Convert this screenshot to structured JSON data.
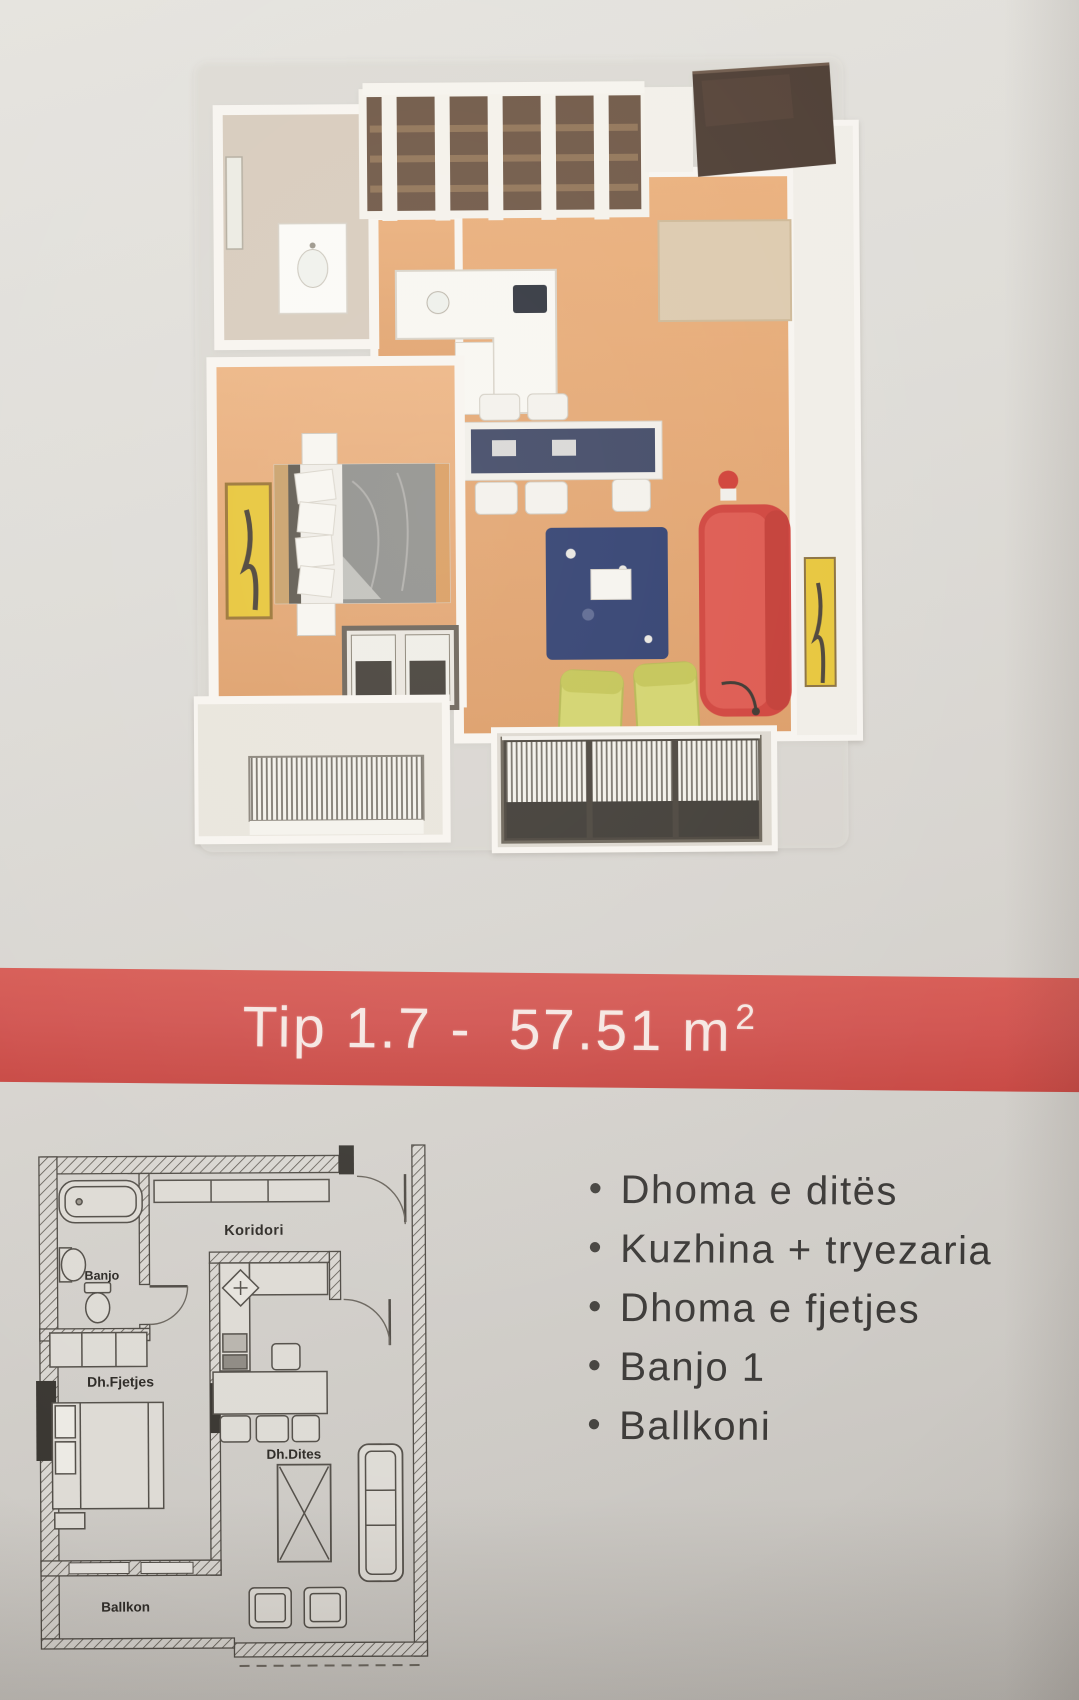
{
  "banner": {
    "title_main": "Tip 1.7 -  57.51 m",
    "title_exponent": "2",
    "background_color": "#d15450",
    "text_color": "#f6e7e2"
  },
  "floorplan_3d": {
    "colors": {
      "wood_floor": "#e3a672",
      "sofa": "#d8473f",
      "lounge_chairs": "#d2d36b",
      "area_rug": "#2e3d6e",
      "wall_art": "#e7c538",
      "bed_duvet": "#90908c",
      "bathroom_floor": "#d7cbbc",
      "dark_wardrobe": "#4b3b31"
    }
  },
  "floorplan_2d": {
    "labels": [
      {
        "id": "koridori",
        "text": "Koridori"
      },
      {
        "id": "banjo",
        "text": "Banjo"
      },
      {
        "id": "dh-fjetjes",
        "text": "Dh.Fjetjes"
      },
      {
        "id": "dh-dites",
        "text": "Dh.Dites"
      },
      {
        "id": "ballkon",
        "text": "Ballkon"
      }
    ]
  },
  "room_list": {
    "bullet_glyph": "•",
    "items": [
      "Dhoma e ditës",
      "Kuzhina + tryezaria",
      "Dhoma e fjetjes",
      "Banjo 1",
      "Ballkoni"
    ]
  },
  "page": {
    "paper_color": "#d9d7d2"
  }
}
